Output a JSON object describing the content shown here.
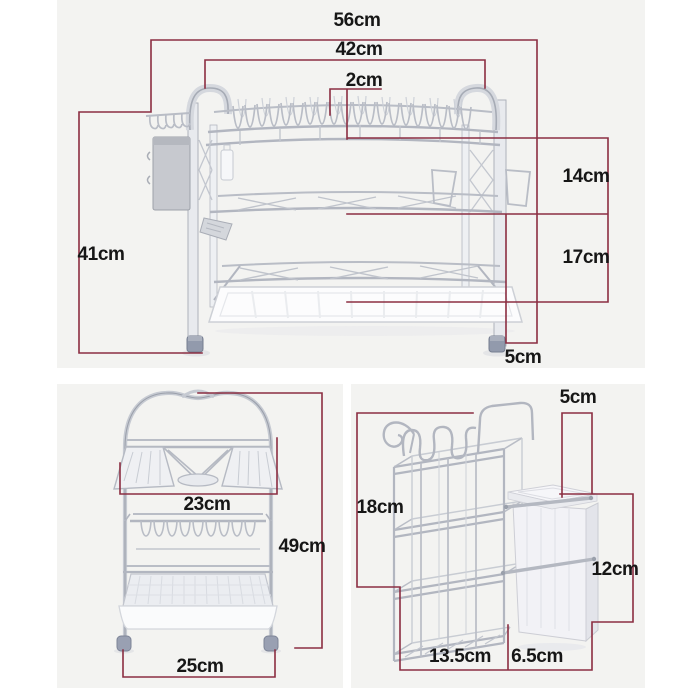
{
  "meta": {
    "units": "cm",
    "dimension_line_color": "#8b2e42",
    "panel_background": "#f3f3f1",
    "chrome_color": "#b9bdc6"
  },
  "top_view": {
    "dims": {
      "total_width": "56cm",
      "inner_width": "42cm",
      "slot_spacing": "2cm",
      "height": "41cm",
      "upper_tier_gap": "14cm",
      "lower_tier_gap": "17cm",
      "handle_overhang": "5cm"
    }
  },
  "side_view": {
    "dims": {
      "top_depth": "23cm",
      "height": "49cm",
      "base_depth": "25cm"
    }
  },
  "accessory_view": {
    "dims": {
      "holder_height": "18cm",
      "hook_width": "5cm",
      "box_height": "12cm",
      "basket_width": "13.5cm",
      "box_width": "6.5cm"
    }
  }
}
